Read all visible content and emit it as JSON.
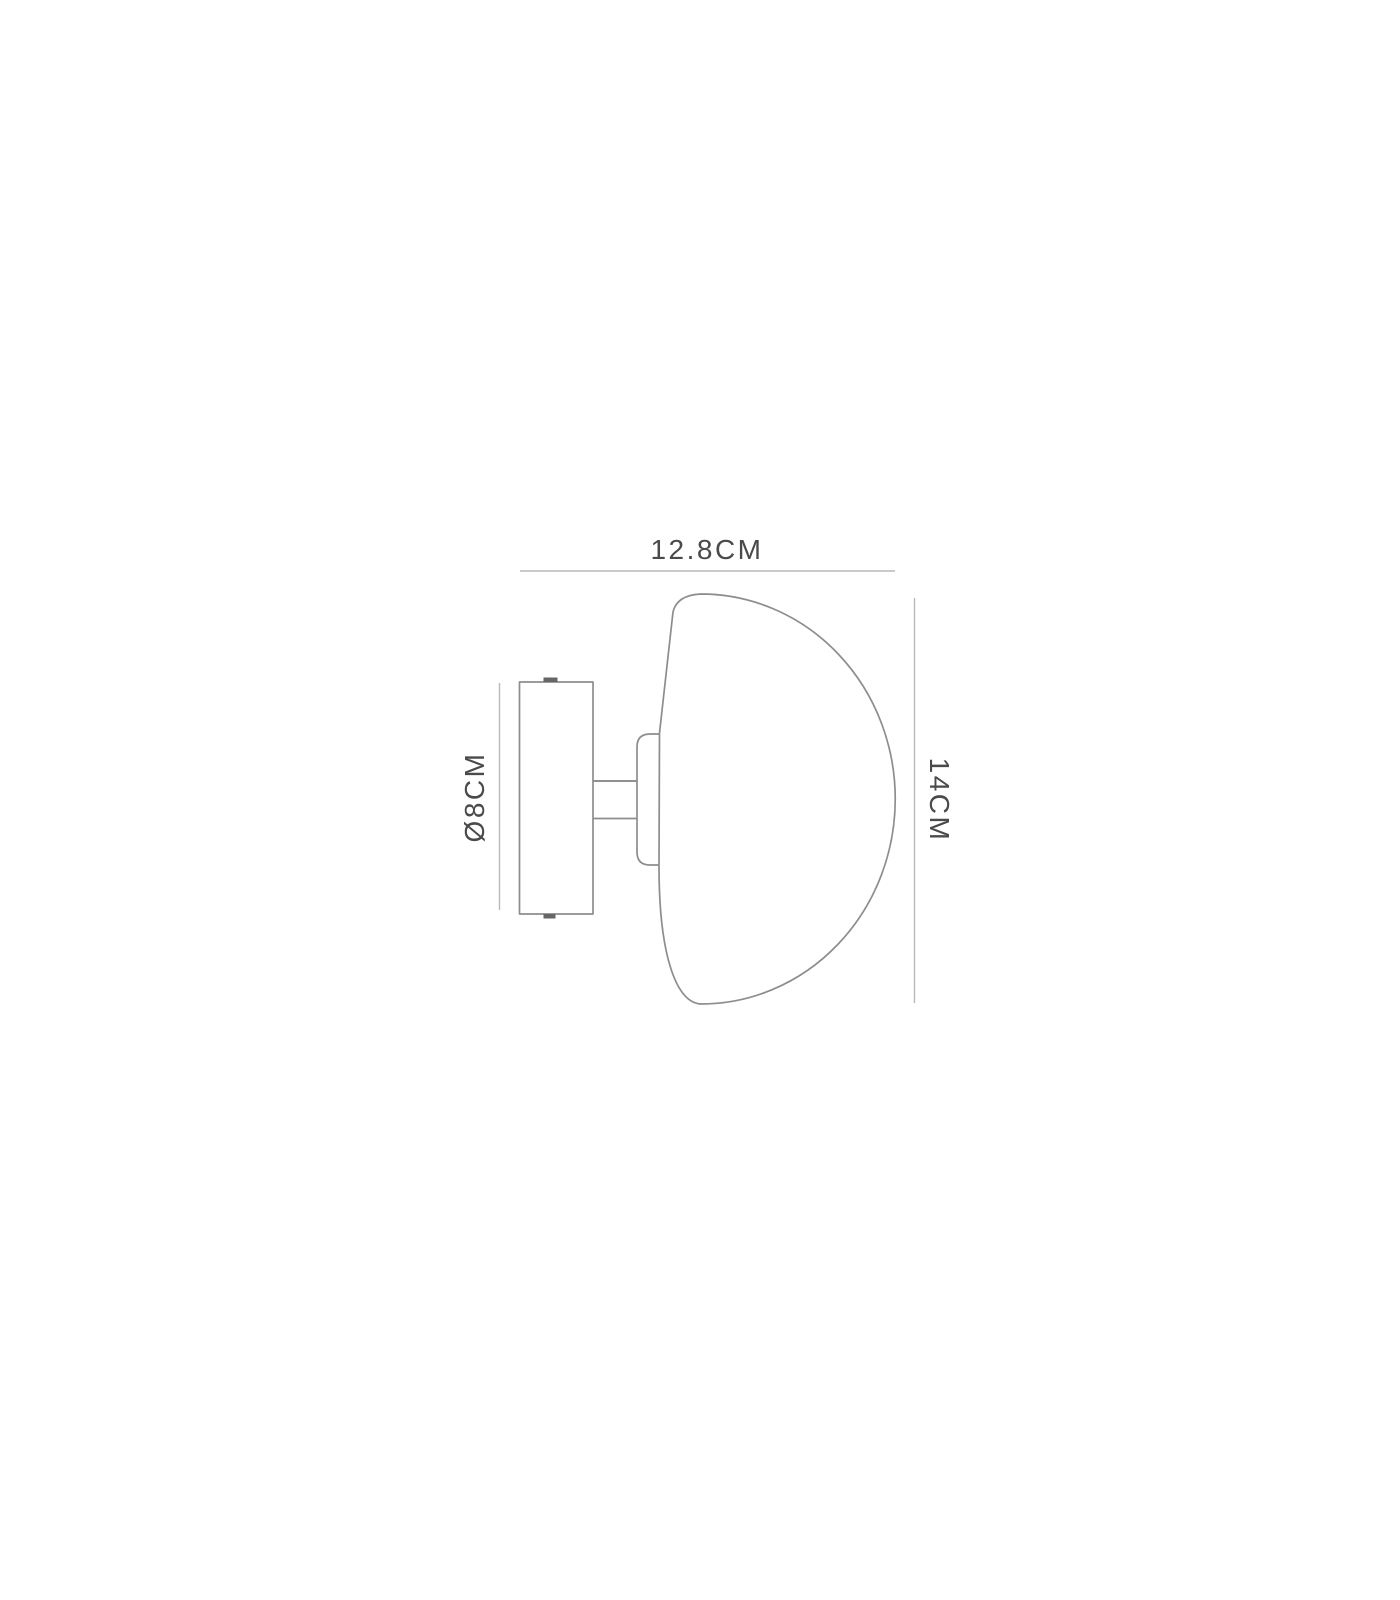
{
  "diagram": {
    "labels": {
      "width": "12.8CM",
      "height": "14CM",
      "diameter": "Ø8CM"
    },
    "colors": {
      "background": "#ffffff",
      "outline": "#8d8d8d",
      "dimension_line": "#b9b9b9",
      "text": "#4a4a4a",
      "screw": "#666666"
    }
  }
}
